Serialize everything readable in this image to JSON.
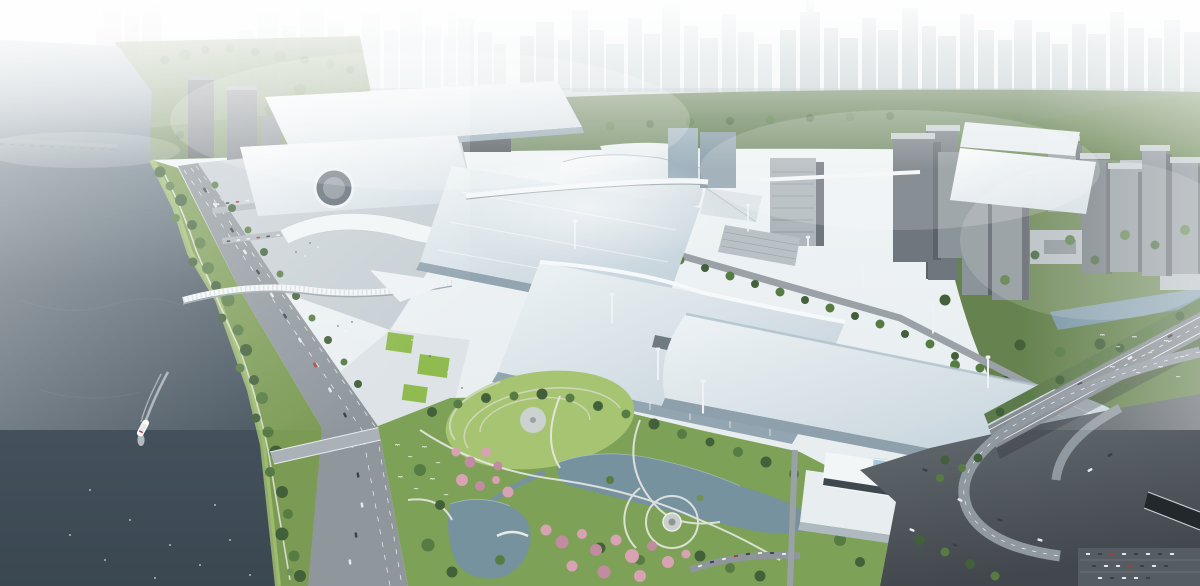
{
  "image": {
    "kind": "architectural-aerial-rendering",
    "subject": "riverside exhibition and convention center complex beside a wide river, with landscaped park, cherry blossoms, highway interchange and hazy city skyline",
    "regions": [
      "hazy-city-skyline",
      "greenbelt",
      "river",
      "boat-with-wake",
      "river-bridge",
      "riverbank-green-strip",
      "riverside-avenue",
      "west-plaza",
      "exhibition-halls",
      "circular-courtyard",
      "skybridge",
      "pedestrian-bridge",
      "office-buildings",
      "central-park",
      "ponds",
      "cherry-blossom-clusters",
      "park-pavilion",
      "conference-building",
      "southeast-roads",
      "elevated-highway",
      "interchange-ramps",
      "tunnel-entrance",
      "parking-lot",
      "right-city-district",
      "canal",
      "birds"
    ],
    "boat_count": 1
  },
  "palette": {
    "sky_top": "#f3f6f7",
    "sky_bottom": "#e4ebee",
    "skyline_far": "#d4dcdf",
    "skyline_mid": "#c2cdd1",
    "skyline_near": "#adbabf",
    "skyline_pink": "#c8b6b2",
    "horizon_band": "#9fadb2",
    "greenbelt": "#5d7a4c",
    "water_light": "#b3c2ca",
    "water_mid": "#4d5b66",
    "water_deep": "#3a4751",
    "water_streak": "#5c6b75",
    "bank_green": "#7b9a54",
    "park_green": "#7da156",
    "lawn_light": "#a6c472",
    "lawn_bright": "#8fbb4f",
    "tree_dark": "#42613a",
    "tree_mid": "#567b43",
    "tree_light": "#6f9355",
    "pink_blossom": "#d8a2b2",
    "pink_deep": "#c18ba0",
    "roof_white": "#fafcfc",
    "roof_shade": "#d3dde3",
    "roof_blue_light": "#eef3f5",
    "roof_blue_shade": "#c3d1da",
    "roof_rib": "#aebbc3",
    "facade": "#93a5b1",
    "plaza": "#c7cfd4",
    "plaza_light": "#dde3e6",
    "road": "#8f979d",
    "road_light": "#9aa2a8",
    "asphalt_light": "#6a7176",
    "asphalt_dark": "#41474c",
    "lane": "#f2f4f5",
    "pond": "#76929f",
    "canal": "#7e99a8",
    "tower_front": "#8b9499",
    "tower_side": "#5b6268",
    "tower_top": "#c2cacf",
    "tower_dark": "#6e777d",
    "bridge_deck": "#aab2b8",
    "mast": "#eef2f4",
    "boat": "#ffffff",
    "bird": "#ffffff"
  }
}
